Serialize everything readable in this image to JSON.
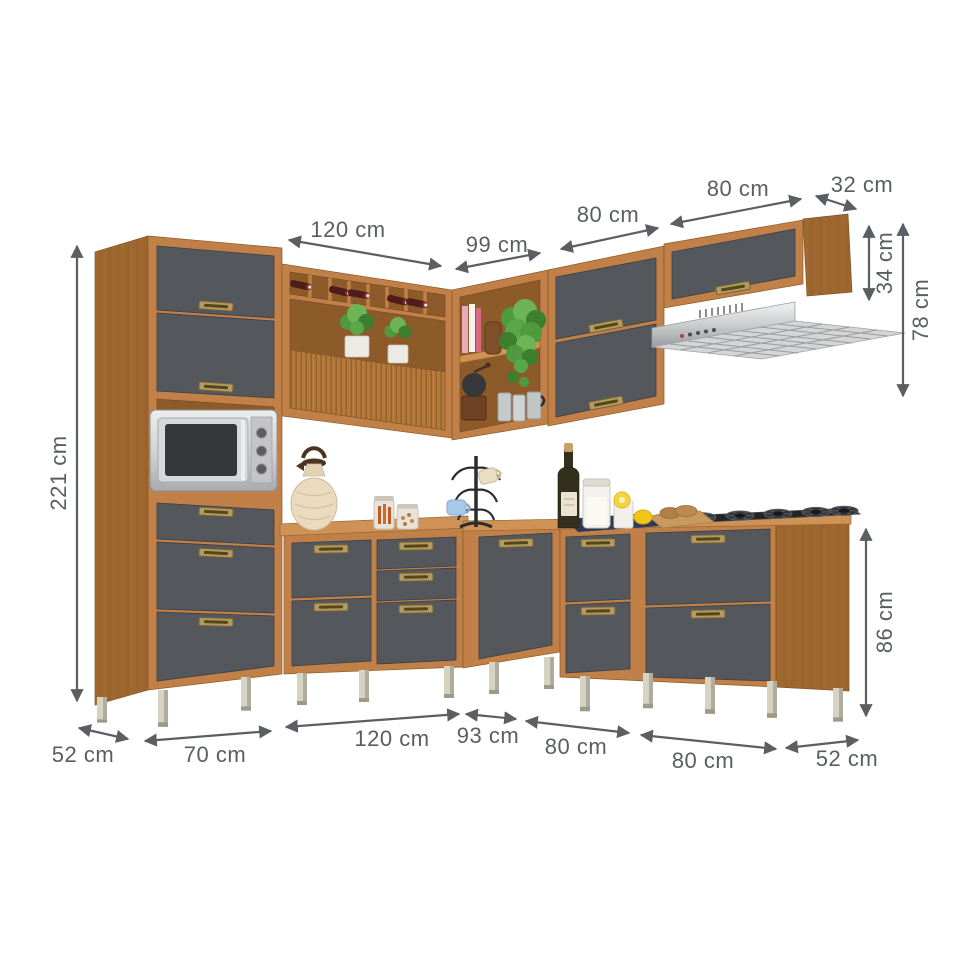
{
  "dimension_unit": "cm",
  "dimensions": {
    "top": [
      {
        "id": "wall-left-width",
        "label": "120 cm"
      },
      {
        "id": "wall-corner-width",
        "label": "99 cm"
      },
      {
        "id": "wall-mid-width",
        "label": "80 cm"
      },
      {
        "id": "wall-hood-width",
        "label": "80 cm"
      },
      {
        "id": "wall-depth",
        "label": "32 cm"
      }
    ],
    "right": [
      {
        "id": "hood-cabinet-height",
        "label": "34 cm"
      },
      {
        "id": "wall-zone-height",
        "label": "78 cm"
      },
      {
        "id": "base-cabinet-height",
        "label": "86 cm"
      }
    ],
    "left": [
      {
        "id": "total-height",
        "label": "221 cm"
      }
    ],
    "bottom": [
      {
        "id": "tall-cabinet-depth",
        "label": "52 cm"
      },
      {
        "id": "tall-cabinet-width",
        "label": "70 cm"
      },
      {
        "id": "base-left-width",
        "label": "120 cm"
      },
      {
        "id": "base-corner-width",
        "label": "93 cm"
      },
      {
        "id": "base-right-1-width",
        "label": "80 cm"
      },
      {
        "id": "base-right-2-width",
        "label": "80 cm"
      },
      {
        "id": "base-depth",
        "label": "52 cm"
      }
    ]
  },
  "palette": {
    "wood": "#c08048",
    "wood_dark": "#9c652e",
    "door_gray": "#54575c",
    "handle_brass": "#b39a5e",
    "metal": "#d7d8d9",
    "leg": "#d4d1be",
    "dimension_text": "#5a5e62"
  },
  "scene": {
    "description": "L-shaped modular kitchen set in wood finish with graphite flip doors and drawers, shown on white background with measurement arrows",
    "units": [
      "tall cabinet with two flip doors, microwave niche, drawer and two doors",
      "wall unit with wine rack cubbies, open shelf and tambour door",
      "corner open wall shelf",
      "double flip-door wall cabinet",
      "flip-door wall cabinet over range hood",
      "base cabinet with drawers and doors",
      "corner base cabinet",
      "two base cabinets with drawer and door"
    ],
    "appliances": [
      "microwave oven",
      "wall range hood",
      "gas cooktop"
    ],
    "accessories": [
      "wine bottles",
      "potted plants",
      "books",
      "hanging plant",
      "coffee grinder",
      "steel canisters",
      "moka pot",
      "thermal carafe",
      "glass jars",
      "mug tree with mugs",
      "wine bottle",
      "storage jar",
      "glass with lemon",
      "lemon",
      "cutting board with bread",
      "kitchen towel"
    ]
  }
}
